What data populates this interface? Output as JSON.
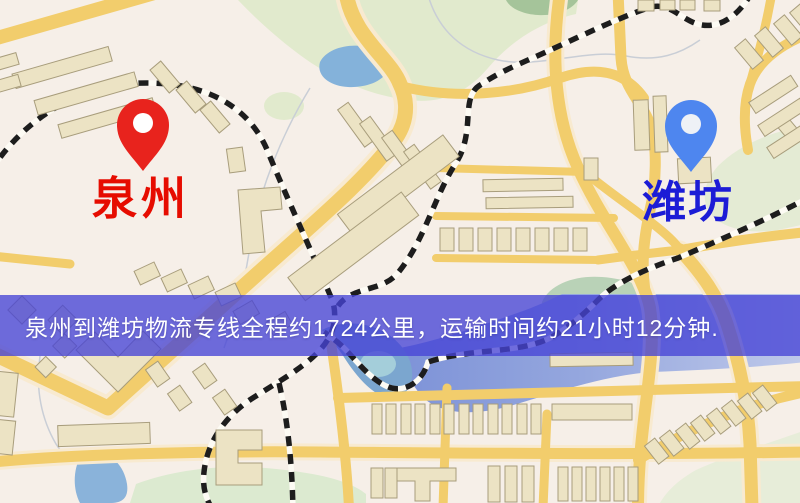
{
  "map": {
    "markers": [
      {
        "id": "origin",
        "label": "泉州",
        "pin_color": "#e8231d",
        "pin_hole_color": "#ffffff",
        "label_color": "#e60c00"
      },
      {
        "id": "destination",
        "label": "潍坊",
        "pin_color": "#4e86ef",
        "pin_hole_color": "#eef1f6",
        "label_color": "#1c1cd6"
      }
    ],
    "banner": {
      "text": "泉州到潍坊物流专线全程约1724公里，运输时间约21小时12分钟.",
      "background_color": "rgba(70,68,214,0.78)",
      "text_color": "#ffffff",
      "distance_km": "1724",
      "duration": "21小时12分钟"
    },
    "palette": {
      "background": "#f6efe8",
      "road": "#f2cd6c",
      "road_halo": "#f8ead0",
      "building": "#ece3c4",
      "building_outline": "#a89d7c",
      "park": "#e1eacd",
      "water": "#8ab3da",
      "railway": "#1d1d1d"
    }
  }
}
